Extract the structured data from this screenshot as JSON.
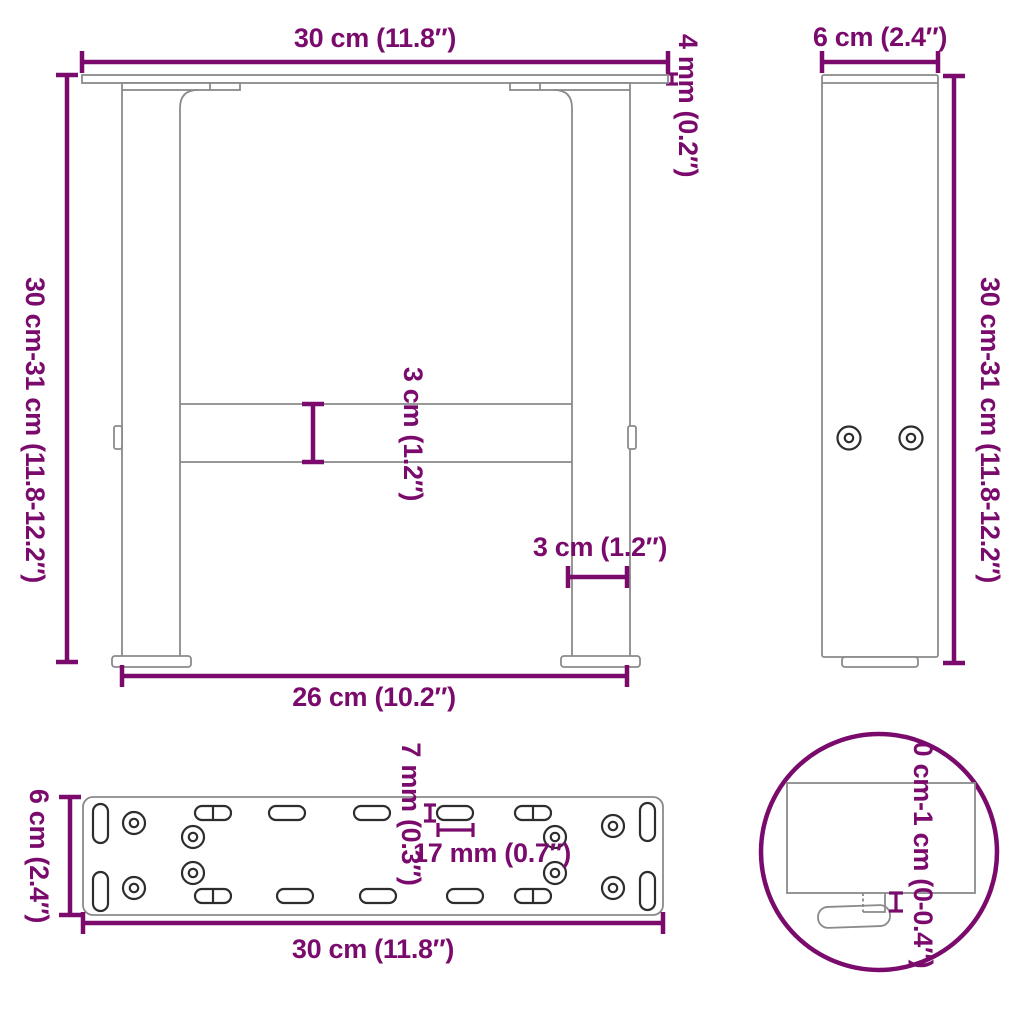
{
  "page": {
    "background": "#ffffff"
  },
  "palette": {
    "accent": "#7A0B6C",
    "outline": "#8A8A8A",
    "hole_outline": "#2D2D2D"
  },
  "front_view": {
    "top_width": "30 cm (11.8″)",
    "plate_thickness": "4 mm (0.2″)",
    "height": "30 cm-31 cm (11.8-12.2″)",
    "crossbar_height": "3 cm (1.2″)",
    "leg_width": "3 cm (1.2″)",
    "feet_span": "26 cm (10.2″)"
  },
  "side_view": {
    "depth": "6 cm (2.4″)",
    "height": "30 cm-31 cm (11.8-12.2″)"
  },
  "plate_view": {
    "depth": "6 cm (2.4″)",
    "width": "30 cm (11.8″)",
    "slot_width": "7 mm (0.3″)",
    "slot_length": "17 mm (0.7″)"
  },
  "detail_view": {
    "adjustable_height": "0 cm-1 cm (0-0.4″)"
  }
}
